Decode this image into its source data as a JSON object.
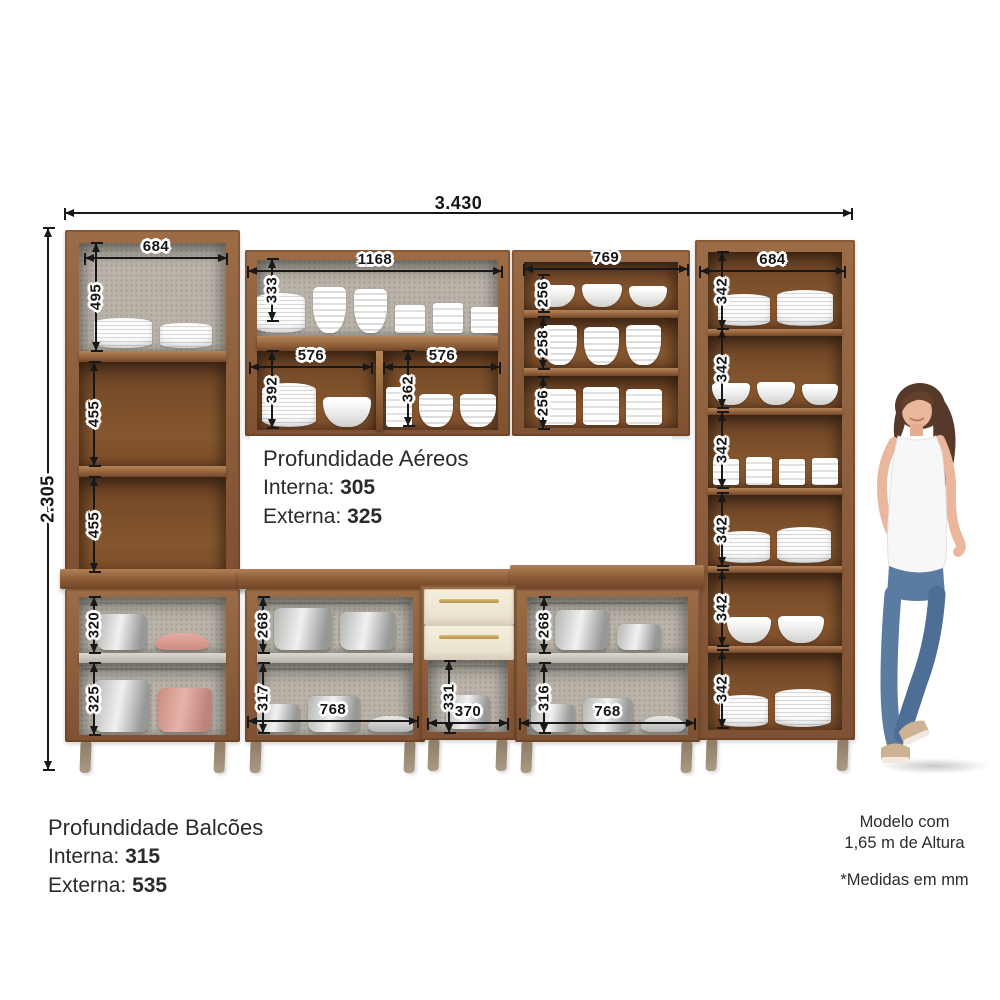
{
  "dims": {
    "total_width": "3.430",
    "total_height": "2.305",
    "upper_left": {
      "width": "684",
      "s1": "495",
      "s2": "455",
      "s3": "455"
    },
    "upper_middle": {
      "width": "1168",
      "top": "333",
      "left_w": "576",
      "left_h": "392",
      "right_w": "576",
      "right_h": "362"
    },
    "upper_right": {
      "width": "769",
      "s1": "256",
      "s2": "258",
      "s3": "256"
    },
    "tall_right": {
      "width": "684",
      "s1": "342",
      "s2": "342",
      "s3": "342",
      "s4": "342",
      "s5": "342",
      "s6": "342"
    },
    "base_left": {
      "s1": "320",
      "s2": "325"
    },
    "base_middle": {
      "width": "768",
      "s1": "268",
      "s2": "317"
    },
    "drawer_unit": {
      "open_height": "331",
      "open_width": "370"
    },
    "base_right": {
      "width": "768",
      "s1": "268",
      "s2": "316"
    }
  },
  "info_aereos": {
    "title": "Profundidade Aéreos",
    "line1_label": "Interna:",
    "line1_value": "305",
    "line2_label": "Externa:",
    "line2_value": "325"
  },
  "info_balcoes": {
    "title": "Profundidade Balcões",
    "line1_label": "Interna:",
    "line1_value": "315",
    "line2_label": "Externa:",
    "line2_value": "535"
  },
  "notes": {
    "model_line1": "Modelo com",
    "model_line2": "1,65 m de Altura",
    "units": "*Medidas em mm"
  },
  "palette": {
    "wood": "#8a5a38",
    "wood_dark": "#6f4426",
    "back_grey": "#b9b3a9",
    "drawer_cream": "#f2ecdc",
    "handle_gold": "#c8a95e",
    "pot_pink": "#dca095",
    "dimension_line": "#181818"
  }
}
